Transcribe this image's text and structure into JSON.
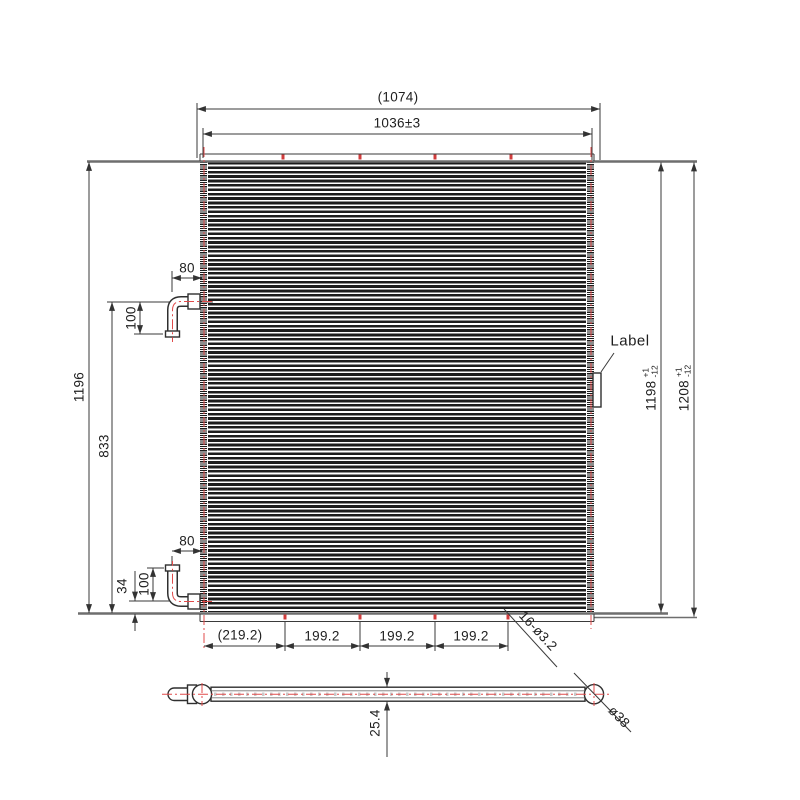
{
  "drawing_labels": {
    "top": {
      "overall_width": "(1074)",
      "fin_width": "1036±3"
    },
    "left": {
      "total_height": "1196",
      "pipe_span": "833",
      "top_pipe": {
        "offset": "80",
        "drop": "100"
      },
      "bottom_pipe": {
        "offset": "80",
        "rise": "100",
        "base_gap": "34"
      }
    },
    "right": {
      "label_tag": "Label",
      "core_height": {
        "value": "1198",
        "tol_upper": "+1",
        "tol_lower": "-12"
      },
      "overall_height": {
        "value": "1208",
        "tol_upper": "+1",
        "tol_lower": "-12"
      }
    },
    "bottom": {
      "segments": [
        "(219.2)",
        "199.2",
        "199.2",
        "199.2"
      ],
      "holes_note": "16-ø3.2"
    },
    "side_view": {
      "thickness": "25.4",
      "header_diameter": "ø38"
    }
  },
  "colors": {
    "centerline_red": "#e14b4b",
    "line_dark": "#3a3a3a",
    "edge_gray": "#6e6e6e",
    "fin_dark": "#1d1d1d",
    "background": "#ffffff"
  }
}
